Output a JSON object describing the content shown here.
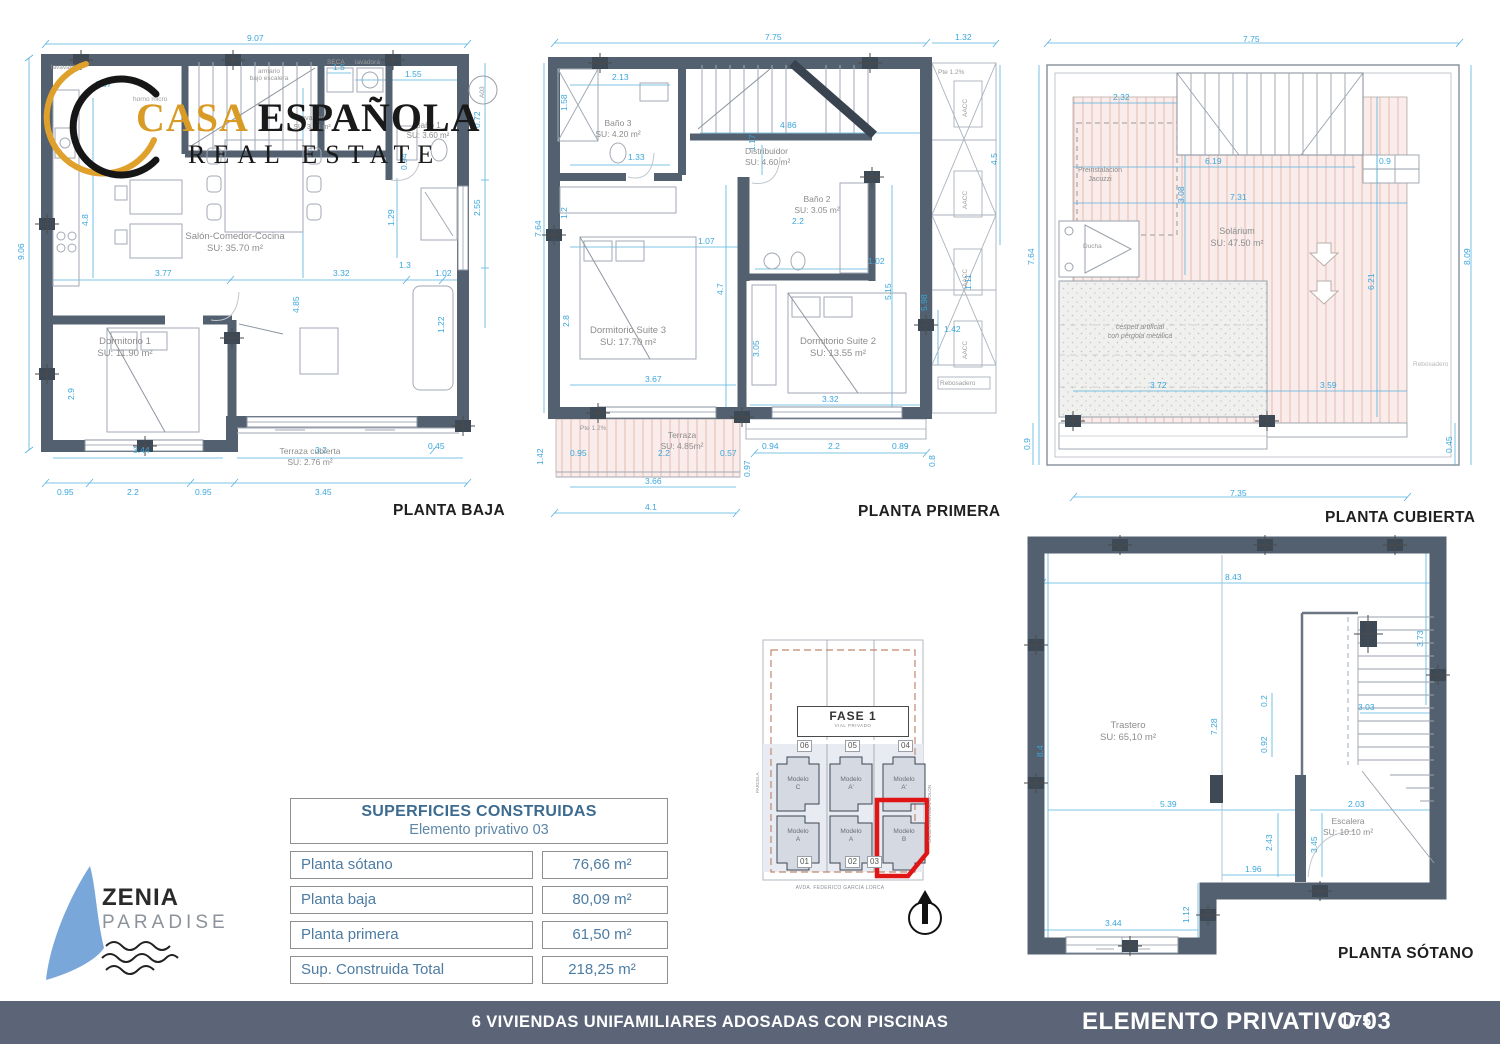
{
  "logo_casa": {
    "word_gold": "CASA",
    "word_black": " ESPAÑOLA",
    "line2": "REAL ESTATE"
  },
  "logo_zenia": {
    "name": "ZENIA",
    "sub": "PARADISE"
  },
  "colors": {
    "wall": "#53606f",
    "dimension": "#3aa6dc",
    "accent_red": "#e01616",
    "footer_bar": "#5b6577",
    "logo_gold": "#d89b26",
    "zenia_blue": "#7aa7d9",
    "table_blue": "#4d7ca3"
  },
  "plans": {
    "baja": {
      "title": "PLANTA BAJA",
      "marker": "A03",
      "rooms": [
        {
          "name": "Salón-Comedor-Cocina",
          "area": "SU: 35.70 m²"
        },
        {
          "name": "Dormitorio 1",
          "area": "SU: 11.90 m²"
        },
        {
          "name": "Terraza cubierta",
          "area": "SU: 2.76 m²"
        },
        {
          "name": "Baño 1",
          "area": "SU: 3.60 m²"
        },
        {
          "name": "Lavadero",
          "area": "SU: 3.25 m²"
        }
      ],
      "small_labels": {
        "armario1": "armario",
        "armario2": "bajo escalera",
        "seca": "SECA",
        "lavadora": "lavadora",
        "lavavajillas": "lavavajillas",
        "horno": "horno micro"
      },
      "dims": [
        "9.07",
        "9.06",
        "1.67",
        "4.8",
        "3.77",
        "2.9",
        "3.44",
        "4.85",
        "3.32",
        "1.3",
        "1.02",
        "1.22",
        "2.55",
        "0.72",
        "1.29",
        "1.55",
        "1.5",
        "0.94",
        "3.2",
        "0.45",
        "0.95",
        "2.2",
        "0.95",
        "3.45"
      ]
    },
    "primera": {
      "title": "PLANTA PRIMERA",
      "aacc": "AACC",
      "rebosadero": "Rebosadero",
      "pte": "Pte 1.2%",
      "rooms": [
        {
          "name": "Baño 3",
          "area": "SU: 4.20 m²"
        },
        {
          "name": "Distribuidor",
          "area": "SU: 4.60 m²"
        },
        {
          "name": "Baño 2",
          "area": "SU: 3.05 m²"
        },
        {
          "name": "Dormitorio Suite 3",
          "area": "SU: 17.70 m²"
        },
        {
          "name": "Dormitorio Suite 2",
          "area": "SU: 13.55 m²"
        },
        {
          "name": "Terraza",
          "area": "SU: 4.85m²"
        }
      ],
      "dims": [
        "7.75",
        "1.32",
        "7.64",
        "2.13",
        "1.58",
        "1.33",
        "1.2",
        "2.8",
        "4.86",
        "1.17",
        "1.07",
        "2.2",
        "1.02",
        "4.7",
        "5.15",
        "3.05",
        "3.67",
        "3.32",
        "5.98",
        "1.11",
        "1.42",
        "4.5",
        "0.95",
        "2.2",
        "0.57",
        "3.66",
        "4.1",
        "1.42",
        "0.97",
        "0.94",
        "2.2",
        "0.89",
        "0.8"
      ]
    },
    "cubierta": {
      "title": "PLANTA CUBIERTA",
      "rooms": [
        {
          "name": "Solárium",
          "area": "SU: 47.50 m²"
        },
        {
          "name": "Preinstalación",
          "area": "Jacuzzi"
        },
        {
          "name": "Ducha",
          "area": ""
        },
        {
          "name": "césped artificial",
          "area": "con pérgola metálica"
        },
        {
          "name": "Rebosadero",
          "area": ""
        }
      ],
      "dims": [
        "7.75",
        "2.32",
        "6.19",
        "7.31",
        "3.08",
        "0.9",
        "7.64",
        "6.21",
        "3.72",
        "3.59",
        "8.09",
        "0.45",
        "0.9",
        "7.35"
      ]
    },
    "sotano": {
      "title": "PLANTA SÓTANO",
      "rooms": [
        {
          "name": "Trastero",
          "area": "SU: 65,10 m²"
        },
        {
          "name": "Escalera",
          "area": "SU: 10.10 m²"
        }
      ],
      "dims": [
        "8.43",
        "3.73",
        "8.4",
        "7.28",
        "0.2",
        "0.92",
        "3.03",
        "5.39",
        "2.03",
        "3.45",
        "2.43",
        "1.96",
        "1.12",
        "3.44"
      ]
    }
  },
  "site_plan": {
    "fase": "FASE 1",
    "vial": "VIAL PRIVADO",
    "plots_top": [
      "06",
      "05",
      "04"
    ],
    "plots_bottom": [
      "01",
      "02",
      "03"
    ],
    "models_top": [
      {
        "l1": "Modelo",
        "l2": "C"
      },
      {
        "l1": "Modelo",
        "l2": "A'"
      },
      {
        "l1": "Modelo",
        "l2": "A'"
      }
    ],
    "models_bottom": [
      {
        "l1": "Modelo",
        "l2": "A"
      },
      {
        "l1": "Modelo",
        "l2": "A"
      },
      {
        "l1": "Modelo",
        "l2": "B"
      }
    ],
    "street_bottom": "AVDA. FEDERICO GARCÍA LORCA",
    "street_right": "CALLE CRISTÓBAL COLÓN",
    "street_left": "PARCELA"
  },
  "areas_table": {
    "title": "SUPERFICIES CONSTRUIDAS",
    "subtitle": "Elemento privativo 03",
    "rows": [
      {
        "label": "Planta sótano",
        "value": "76,66 m²"
      },
      {
        "label": "Planta baja",
        "value": "80,09 m²"
      },
      {
        "label": "Planta primera",
        "value": "61,50 m²"
      },
      {
        "label": "Sup. Construida Total",
        "value": "218,25 m²"
      }
    ]
  },
  "footer": {
    "project": "6 VIVIENDAS UNIFAMILIARES ADOSADAS CON PISCINAS",
    "sheet": "ELEMENTO PRIVATIVO 03",
    "page": "1/75"
  }
}
